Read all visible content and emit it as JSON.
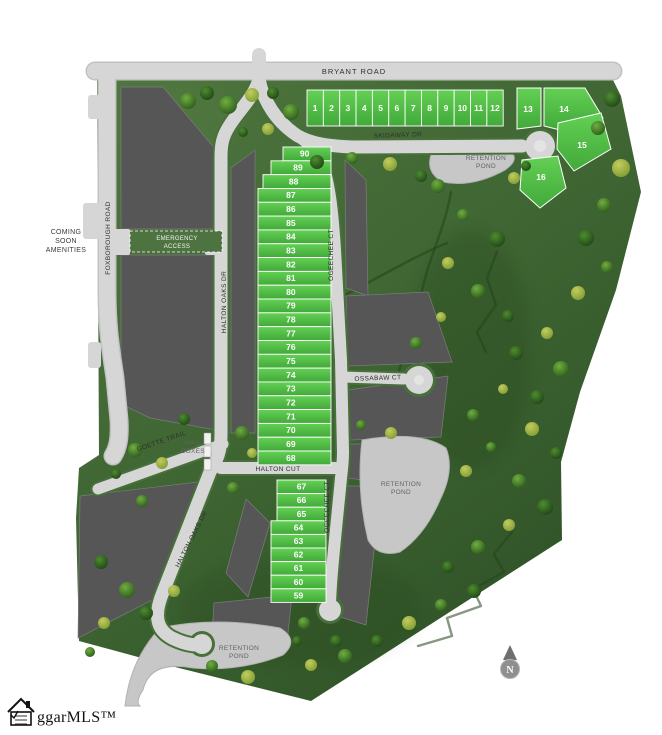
{
  "map": {
    "roads": {
      "bryant": "BRYANT ROAD",
      "skidaway": "SKIDAWAY DR",
      "foxborough": "FOXBOROUGH ROAD",
      "halton_oaks_upper": "HALTON OAKS DR",
      "halton_oaks_lower": "HALTON OAKS DR",
      "ogeechee_upper": "OGEECHEE CT",
      "ogeechee_lower": "OGEECHEE CT",
      "ossabaw": "OSSABAW CT",
      "halton_cut": "HALTON CUT",
      "goette": "GOETTE TRAIL"
    },
    "labels": {
      "coming_soon_1": "COMING",
      "coming_soon_2": "SOON",
      "coming_soon_3": "AMENITIES",
      "emergency_1": "EMERGENCY",
      "emergency_2": "ACCESS",
      "mail_1": "MAIL",
      "mail_2": "BOXES",
      "retention_1": "RETENTION",
      "retention_2": "POND"
    },
    "lots": {
      "north_row": [
        "1",
        "2",
        "3",
        "4",
        "5",
        "6",
        "7",
        "8",
        "9",
        "10",
        "11",
        "12"
      ],
      "east_cluster": [
        "13",
        "14",
        "15",
        "16"
      ],
      "central_column": [
        "90",
        "89",
        "88",
        "87",
        "86",
        "85",
        "84",
        "83",
        "82",
        "81",
        "80",
        "79",
        "78",
        "77",
        "76",
        "75",
        "74",
        "73",
        "72",
        "71",
        "70",
        "69",
        "68"
      ],
      "south_column": [
        "67",
        "66",
        "65",
        "64",
        "63",
        "62",
        "61",
        "60",
        "59"
      ]
    },
    "compass_n": "N",
    "logo_text": "ggarMLS™",
    "colors": {
      "lot_green": "#52c349",
      "site_green": "#436635",
      "road_gray": "#d6d6d6",
      "parcel_gray": "#565656",
      "pond_gray": "#c7c7c7"
    }
  }
}
